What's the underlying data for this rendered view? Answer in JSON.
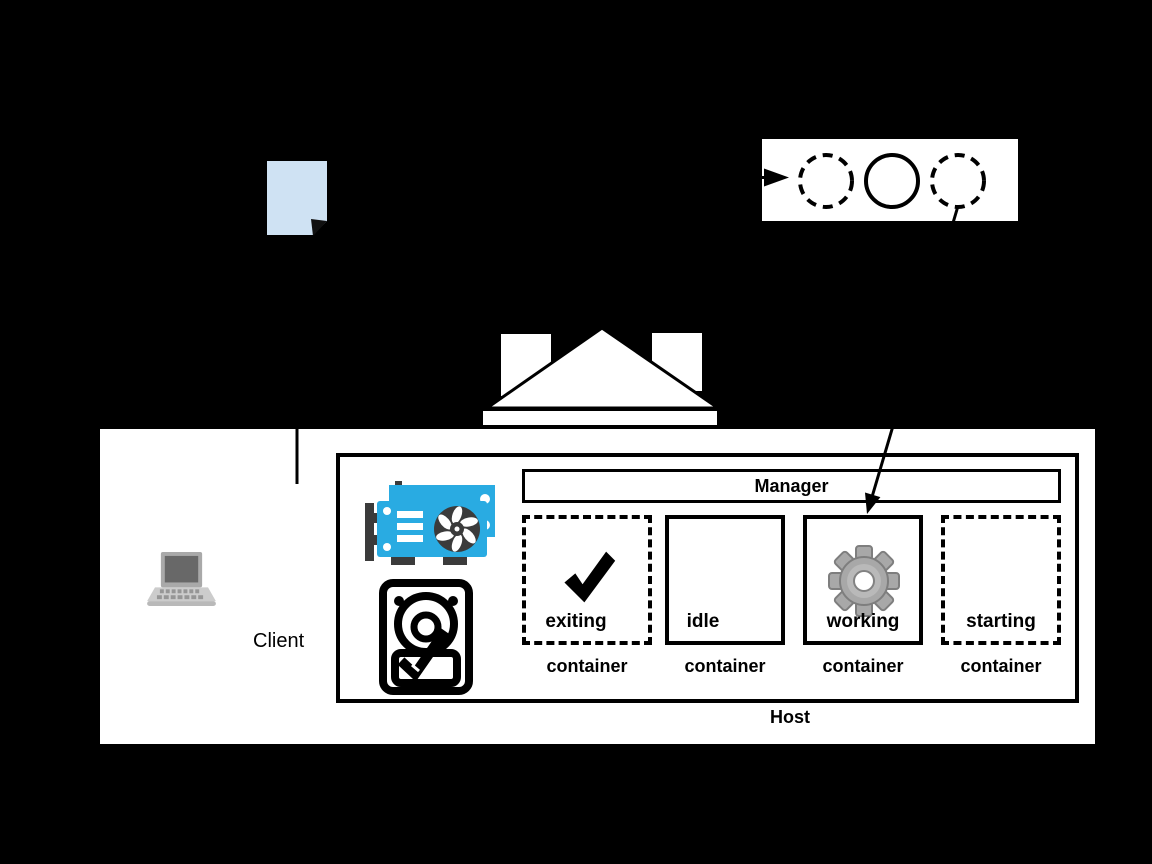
{
  "colors": {
    "background": "#000000",
    "surface": "#ffffff",
    "line": "#000000",
    "document_fill": "#cfe2f3",
    "gpu_blue": "#29abe2",
    "gpu_dark": "#3b3b3b",
    "gear_gray": "#a8a8a8"
  },
  "document": {
    "icon": "document-icon"
  },
  "lifecycle_panel": {
    "icon": "container-lifecycle-strip",
    "circles": [
      {
        "style": "dashed"
      },
      {
        "style": "solid"
      },
      {
        "style": "dashed"
      }
    ]
  },
  "building": {
    "icon": "house-shape"
  },
  "client": {
    "label": "Client",
    "icon": "laptop-icon"
  },
  "host": {
    "label": "Host",
    "manager_label": "Manager",
    "hardware_icons": [
      "gpu-icon",
      "hard-disk-icon"
    ],
    "containers": [
      {
        "state": "exiting",
        "type_label": "container",
        "border": "dashed",
        "icon": "checkmark-icon"
      },
      {
        "state": "idle",
        "type_label": "container",
        "border": "solid",
        "icon": ""
      },
      {
        "state": "working",
        "type_label": "container",
        "border": "solid",
        "icon": "gear-icon"
      },
      {
        "state": "starting",
        "type_label": "container",
        "border": "dashed",
        "icon": ""
      }
    ]
  }
}
